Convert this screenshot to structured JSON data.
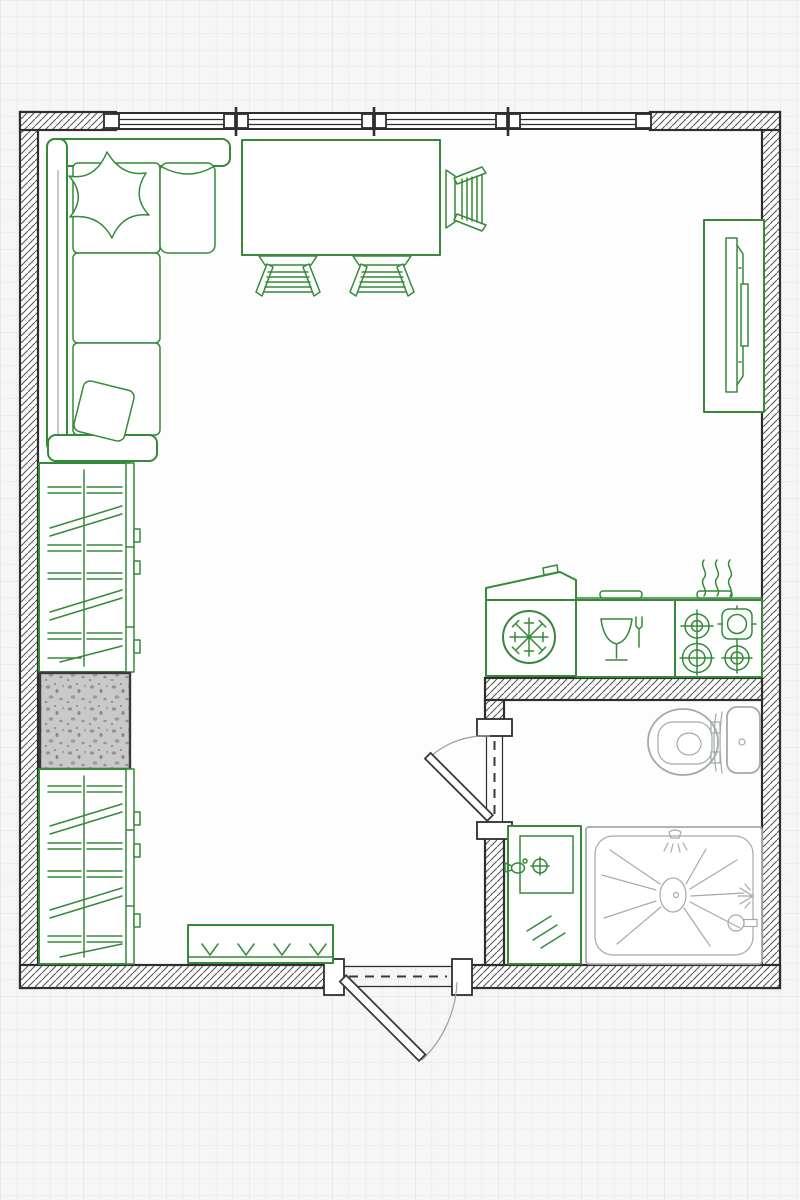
{
  "meta": {
    "title": "Studio apartment floor plan",
    "canvas": {
      "width": 800,
      "height": 1200
    },
    "style": "top-down architectural drawing, green furniture symbols, hatched walls, graph-paper background"
  },
  "palette": {
    "green": "#348a38",
    "wall": "#2e2e2e",
    "wall_hatch": "#565656",
    "fixture": "#a4a9a9",
    "grid_bg": "#f6f6f7",
    "grid_line": "#e7e7ea",
    "interior": "#fdfdfe",
    "column_fill": "#c9c9c9"
  },
  "rooms": [
    {
      "id": "living-kitchen",
      "label": "Main living / kitchen area",
      "bbox": [
        38,
        130,
        724,
        548
      ]
    },
    {
      "id": "bathroom",
      "label": "Bathroom",
      "bbox": [
        504,
        700,
        258,
        265
      ]
    }
  ],
  "walls": [
    {
      "id": "wall-left",
      "bbox": [
        20,
        112,
        18,
        876
      ]
    },
    {
      "id": "wall-right",
      "bbox": [
        762,
        112,
        18,
        876
      ]
    },
    {
      "id": "wall-top-left",
      "bbox": [
        20,
        112,
        96,
        18
      ]
    },
    {
      "id": "wall-top-right",
      "bbox": [
        650,
        112,
        130,
        18
      ]
    },
    {
      "id": "wall-bottom-left",
      "bbox": [
        20,
        965,
        314,
        23
      ]
    },
    {
      "id": "wall-bottom-right",
      "bbox": [
        456,
        965,
        324,
        23
      ]
    },
    {
      "id": "wall-bathroom-top",
      "bbox": [
        485,
        678,
        277,
        22
      ]
    },
    {
      "id": "wall-bathroom-partition-upper",
      "bbox": [
        485,
        700,
        19,
        26
      ]
    },
    {
      "id": "wall-bathroom-partition-lower",
      "bbox": [
        485,
        834,
        19,
        131
      ]
    }
  ],
  "windows": {
    "wall": "top",
    "band_x": [
      116,
      650
    ],
    "mullion_centers_x": [
      236,
      374,
      508
    ],
    "end_blocks_x": [
      104,
      636
    ]
  },
  "doors": [
    {
      "id": "entry-door",
      "wall": "bottom",
      "opening_x": [
        344,
        452
      ],
      "swing": "outward, hinged left"
    },
    {
      "id": "bathroom-door",
      "wall": "bathroom-partition",
      "opening_y": [
        736,
        822
      ],
      "swing": "into living area, hinged bottom"
    }
  ],
  "furniture": [
    {
      "id": "sofa",
      "label": "L-shaped corner sofa",
      "room": "living-kitchen",
      "bbox": [
        47,
        139,
        168,
        323
      ],
      "color": "green"
    },
    {
      "id": "pillow-top",
      "label": "Throw pillow (star shape)",
      "room": "living-kitchen",
      "bbox": [
        68,
        150,
        80,
        88
      ],
      "color": "green"
    },
    {
      "id": "pillow-bottom",
      "label": "Throw pillow (square)",
      "room": "living-kitchen",
      "bbox": [
        76,
        383,
        56,
        56
      ],
      "color": "green"
    },
    {
      "id": "dining-table",
      "label": "Rectangular dining table",
      "room": "living-kitchen",
      "bbox": [
        242,
        140,
        198,
        115
      ],
      "color": "green"
    },
    {
      "id": "chair-1",
      "label": "Ladder-back chair (under table, left)",
      "room": "living-kitchen",
      "bbox": [
        255,
        256,
        66,
        37
      ],
      "color": "green"
    },
    {
      "id": "chair-2",
      "label": "Ladder-back chair (under table, right)",
      "room": "living-kitchen",
      "bbox": [
        349,
        256,
        66,
        37
      ],
      "color": "green"
    },
    {
      "id": "chair-3",
      "label": "Ladder-back chair (right side of table)",
      "room": "living-kitchen",
      "bbox": [
        445,
        165,
        40,
        68
      ],
      "color": "green"
    },
    {
      "id": "tv-unit",
      "label": "TV on media unit",
      "room": "living-kitchen",
      "bbox": [
        704,
        220,
        60,
        192
      ],
      "color": "green"
    },
    {
      "id": "wardrobe-upper",
      "label": "Wardrobe with hanging clothes (upper)",
      "room": "living-kitchen",
      "bbox": [
        39,
        463,
        91,
        209
      ],
      "color": "green"
    },
    {
      "id": "structural-column",
      "label": "Concrete column / shaft (speckled)",
      "room": "living-kitchen",
      "bbox": [
        40,
        673,
        90,
        96
      ],
      "color": "gray"
    },
    {
      "id": "wardrobe-lower",
      "label": "Wardrobe with hanging clothes (lower)",
      "room": "living-kitchen",
      "bbox": [
        39,
        769,
        91,
        195
      ],
      "color": "green"
    },
    {
      "id": "bench",
      "label": "Entry bench with chevron slats",
      "room": "living-kitchen",
      "bbox": [
        188,
        925,
        145,
        38
      ],
      "color": "green"
    },
    {
      "id": "refrigerator",
      "label": "Refrigerator (snowflake symbol, open lid)",
      "room": "living-kitchen",
      "bbox": [
        486,
        572,
        90,
        104
      ],
      "color": "green"
    },
    {
      "id": "dishwasher",
      "label": "Dishwasher (glass & fork symbol)",
      "room": "living-kitchen",
      "bbox": [
        576,
        600,
        99,
        77
      ],
      "color": "green"
    },
    {
      "id": "cooktop",
      "label": "4-burner cooktop with heat squiggles",
      "room": "living-kitchen",
      "bbox": [
        675,
        600,
        87,
        77
      ],
      "burners": 4,
      "color": "green"
    },
    {
      "id": "washbasin-cabinet",
      "label": "Washbasin cabinet with faucet",
      "room": "bathroom",
      "bbox": [
        508,
        826,
        73,
        138
      ],
      "color": "green"
    },
    {
      "id": "shower",
      "label": "Shower tray with drain, head and mixer",
      "room": "bathroom",
      "bbox": [
        586,
        827,
        176,
        137
      ],
      "color": "gray"
    },
    {
      "id": "toilet",
      "label": "Toilet with cistern",
      "room": "bathroom",
      "bbox": [
        648,
        707,
        112,
        68
      ],
      "color": "gray"
    }
  ]
}
